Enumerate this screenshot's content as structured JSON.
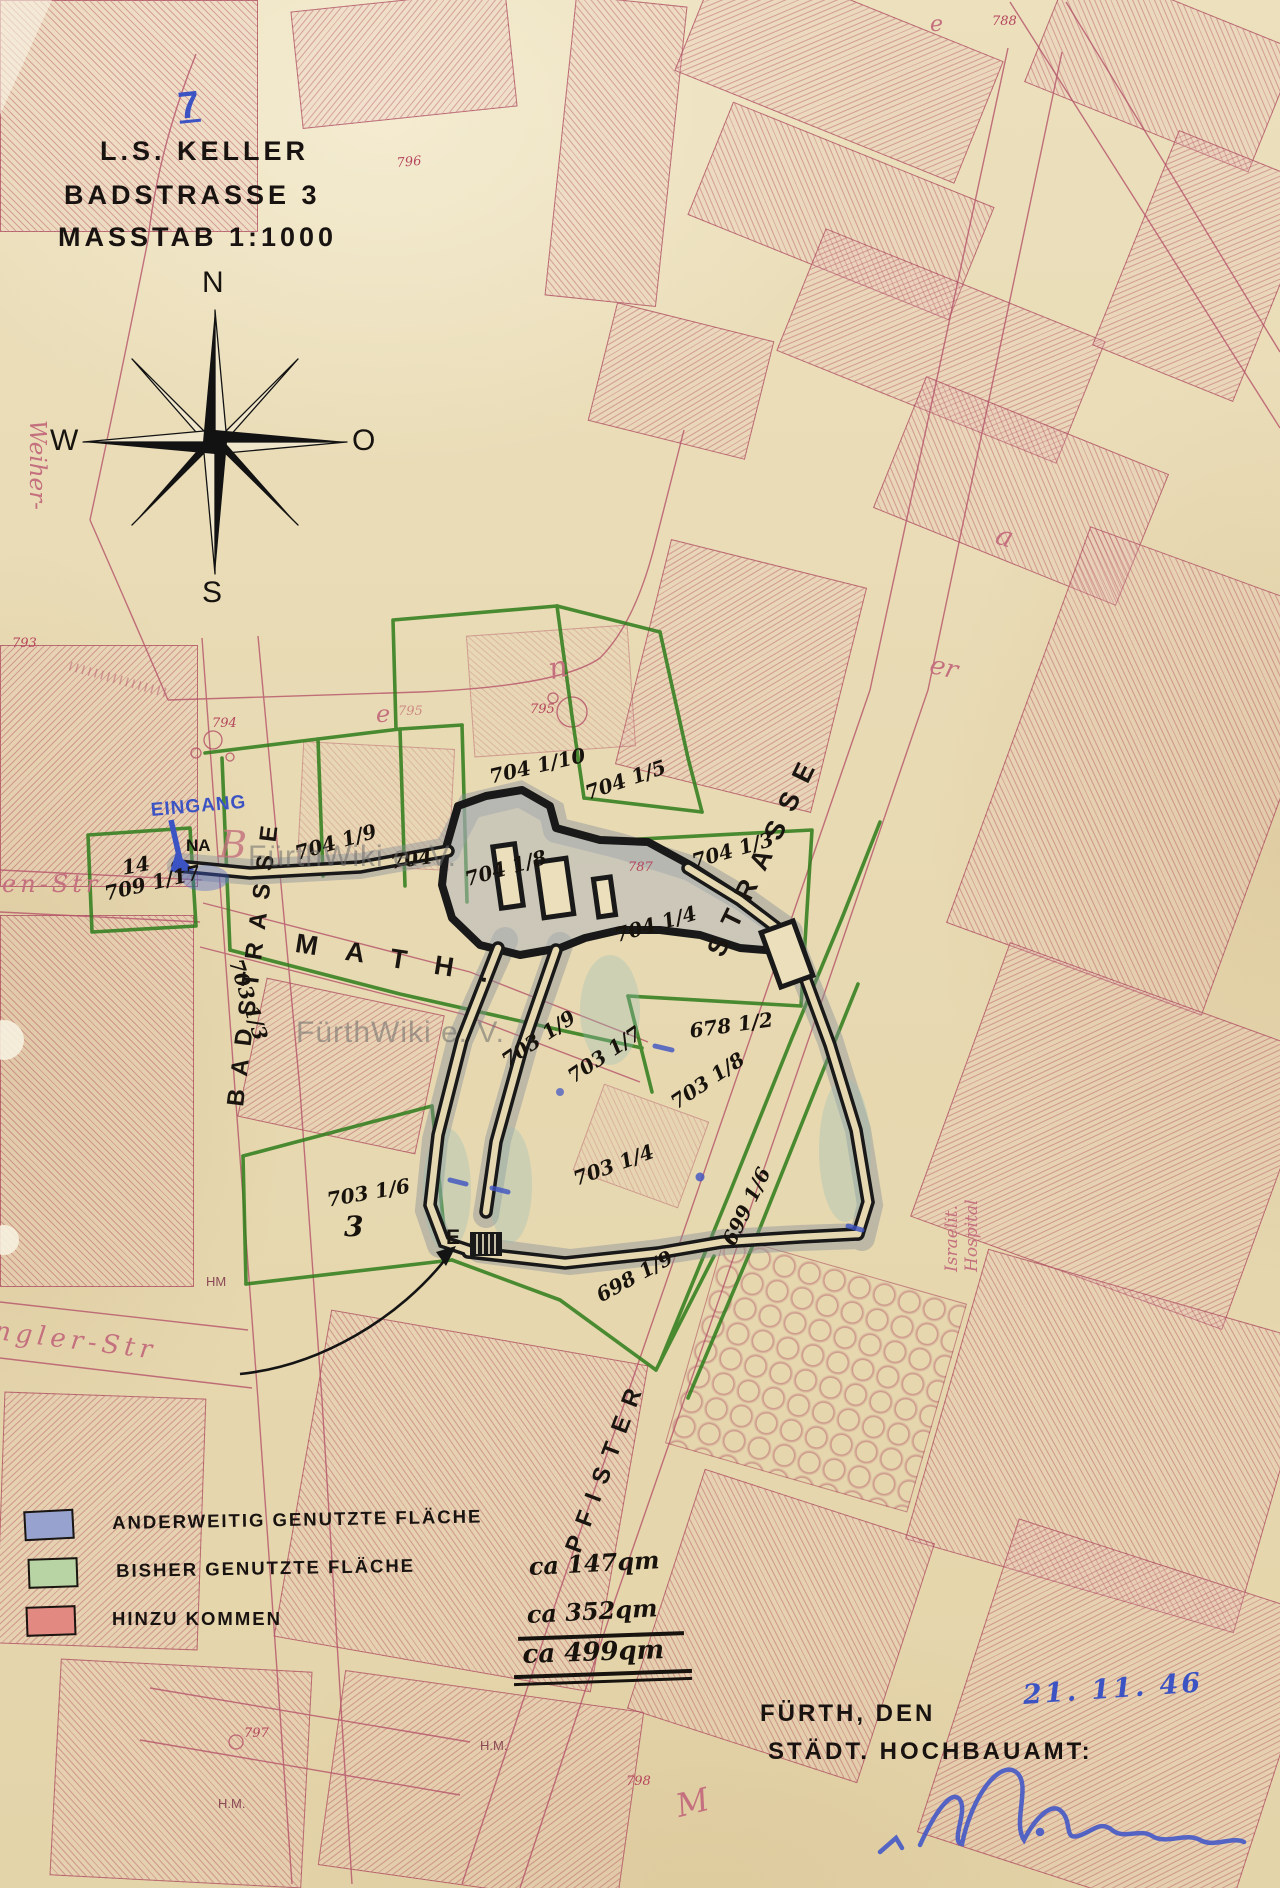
{
  "document": {
    "page_number": "7",
    "title_line1": "L.S. KELLER",
    "title_line2": "BADSTRASSE 3",
    "title_line3": "MASSTAB 1:1000",
    "watermark": "FürthWiki e. V."
  },
  "compass": {
    "n": "N",
    "s": "S",
    "w": "W",
    "o": "O"
  },
  "legend": {
    "rows": [
      {
        "label": "ANDERWEITIG GENUTZTE FLÄCHE",
        "value": "",
        "swatch": "#98a2cf"
      },
      {
        "label": "BISHER GENUTZTE FLÄCHE",
        "value": "ca 147qm",
        "swatch": "#b9d4a4"
      },
      {
        "label": "HINZU KOMMEN",
        "value": "ca 352qm",
        "swatch": "#e28a82"
      }
    ],
    "total_value": "ca 499qm"
  },
  "footer": {
    "place": "FÜRTH, DEN",
    "date_handwritten": "21. 11. 46",
    "office": "STÄDT. HOCHBAUAMT:"
  },
  "streets": {
    "math": "MATH.",
    "badstrasse": "BADSTRASSE",
    "pfister": "PFISTER",
    "strasse": "STRASSE",
    "en_str": "en-Str",
    "ngler": "ngler-Str",
    "weiher": "Weiher-",
    "israelit_1": "Israelit.",
    "israelit_2": "Hospital"
  },
  "labels": {
    "eingang": "EINGANG",
    "na": "NA",
    "e": "E",
    "nr14": "14",
    "p709": "709 1/17",
    "parcels": [
      "704 1/10",
      "704 1/5",
      "704 1/9",
      "704",
      "704 1/8",
      "704 1/3",
      "704 1/4",
      "678 1/2",
      "703 1/9",
      "703 1/7",
      "703 1/8",
      "703 1/4",
      "703 1/6",
      "3",
      "699 1/6",
      "698 1/9",
      "703 1/3"
    ]
  },
  "survey": {
    "numbers": [
      "796",
      "788",
      "787",
      "793",
      "794",
      "795",
      "795",
      "797",
      "798"
    ],
    "hm": [
      "HM",
      "H.M.",
      "H.M."
    ]
  },
  "old_letters": [
    "B",
    "n",
    "e",
    "a",
    "er",
    "e",
    "M"
  ],
  "colors": {
    "paper": "#e8dab3",
    "map_red": "#b5536a",
    "parcel_green": "#2e7d1b",
    "ink_black": "#17130f",
    "hand_blue": "#3c53c3",
    "pencil_gray": "#8e959e"
  }
}
